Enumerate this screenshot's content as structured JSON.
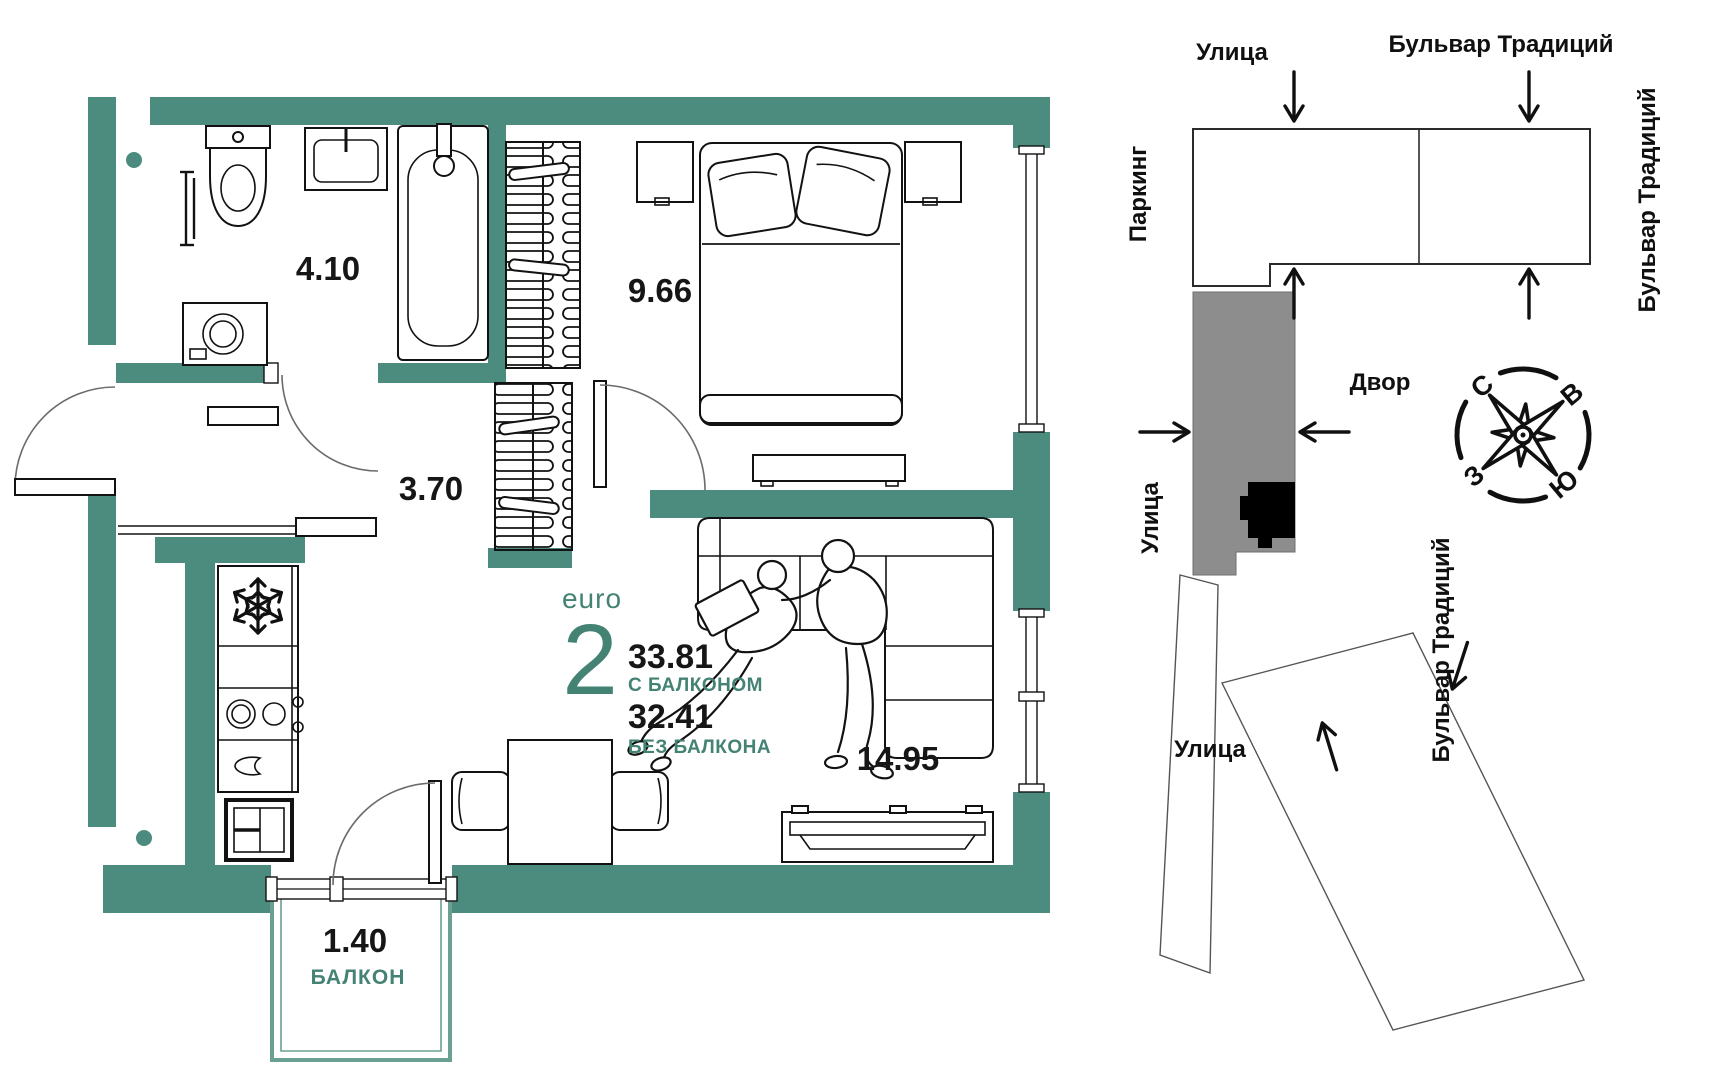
{
  "colors": {
    "wall_teal": "#4c8c7e",
    "balcony_teal": "#6aa092",
    "accent_teal": "#448274",
    "grey_building": "#8d8d8d",
    "marker_black": "#000000",
    "text_black": "#161616"
  },
  "floor_plan": {
    "rooms": [
      {
        "id": "bathroom",
        "area": "4.10"
      },
      {
        "id": "bedroom",
        "area": "9.66"
      },
      {
        "id": "hallway",
        "area": "3.70"
      },
      {
        "id": "living-kitchen",
        "area": "14.95"
      },
      {
        "id": "balcony",
        "area": "1.40",
        "name": "БАЛКОН"
      }
    ],
    "summary": {
      "type_label": "euro",
      "rooms_count": "2",
      "area_with_balcony": "33.81",
      "with_balcony_label": "С БАЛКОНОМ",
      "area_without_balcony": "32.41",
      "without_balcony_label": "БЕЗ БАЛКОНА"
    }
  },
  "site_plan": {
    "labels": {
      "street_top": "Улица",
      "boulevard_top": "Бульвар Традиций",
      "parking": "Паркинг",
      "boulevard_right": "Бульвар Традиций",
      "street_left": "Улица",
      "courtyard": "Двор",
      "street_bottom": "Улица",
      "boulevard_bottom_right": "Бульвар Традиций"
    },
    "compass": {
      "north": "С",
      "east": "В",
      "south": "Ю",
      "west": "З"
    }
  }
}
